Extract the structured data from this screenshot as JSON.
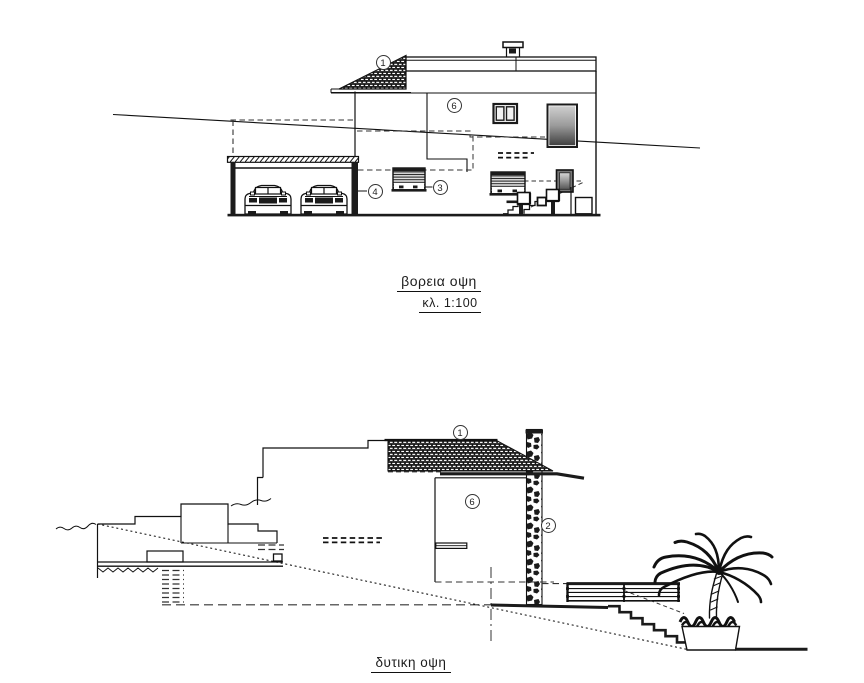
{
  "document": {
    "background": "#ffffff",
    "line_color": "#1b1b1b",
    "type_note": "architectural elevation drawings"
  },
  "north_elevation": {
    "caption": "βορεια οψη",
    "scale_label": "κλ. 1:100",
    "callouts": [
      {
        "label": "1",
        "x": 383,
        "y": 62
      },
      {
        "label": "6",
        "x": 454,
        "y": 105
      },
      {
        "label": "3",
        "x": 440,
        "y": 187
      },
      {
        "label": "4",
        "x": 375,
        "y": 191
      }
    ]
  },
  "west_elevation": {
    "caption": "δυτικη οψη",
    "callouts": [
      {
        "label": "1",
        "x": 460,
        "y": 432
      },
      {
        "label": "6",
        "x": 472,
        "y": 501
      },
      {
        "label": "2",
        "x": 548,
        "y": 525
      }
    ]
  }
}
